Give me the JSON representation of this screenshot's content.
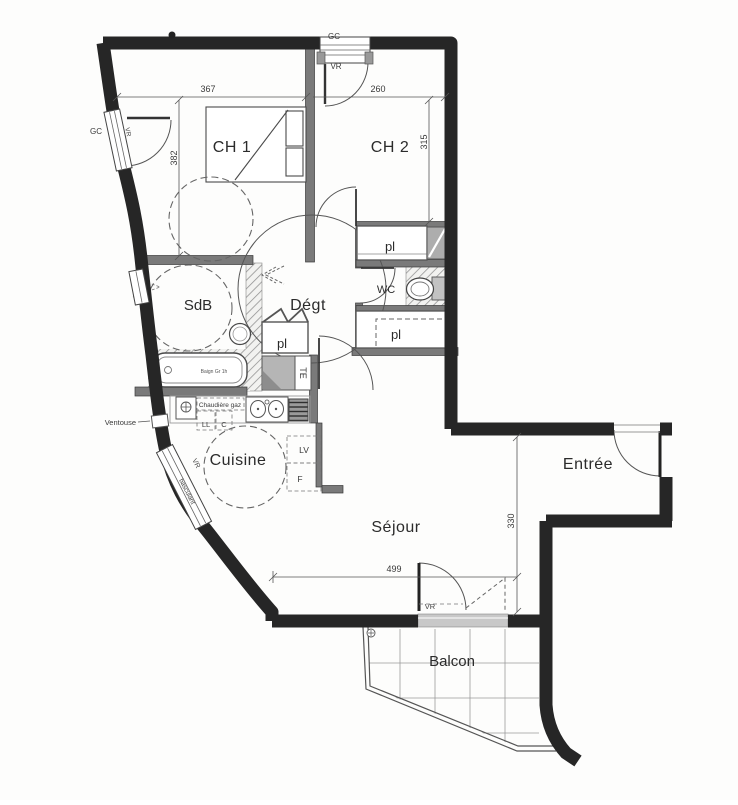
{
  "plan": {
    "rooms": {
      "ch1": "CH 1",
      "ch2": "CH 2",
      "sdb": "SdB",
      "degt": "Dégt",
      "wc": "WC",
      "pl_top": "pl",
      "pl_hall": "pl",
      "pl_bottom": "pl",
      "cuisine": "Cuisine",
      "sejour": "Séjour",
      "entree": "Entrée",
      "balcon": "Balcon"
    },
    "dimensions_cm": {
      "ch1_width": "367",
      "ch2_width": "260",
      "ch1_depth": "382",
      "ch2_depth": "315",
      "sejour_depth": "330",
      "sejour_width": "499"
    },
    "annotations": {
      "gc_left": "GC",
      "gc_top": "GC",
      "vr_top": "VR",
      "vr_left": "VR",
      "vr_kitchen": "VR",
      "vr_balcony": "VR",
      "window_type": "basculant",
      "ventouse": "Ventouse",
      "boiler": "Chaudière gaz",
      "washer": "LL",
      "c_slot": "C",
      "dishwasher": "LV",
      "fridge": "F",
      "electrical": "TE",
      "bathtub": "Baign Gr 1h"
    }
  }
}
